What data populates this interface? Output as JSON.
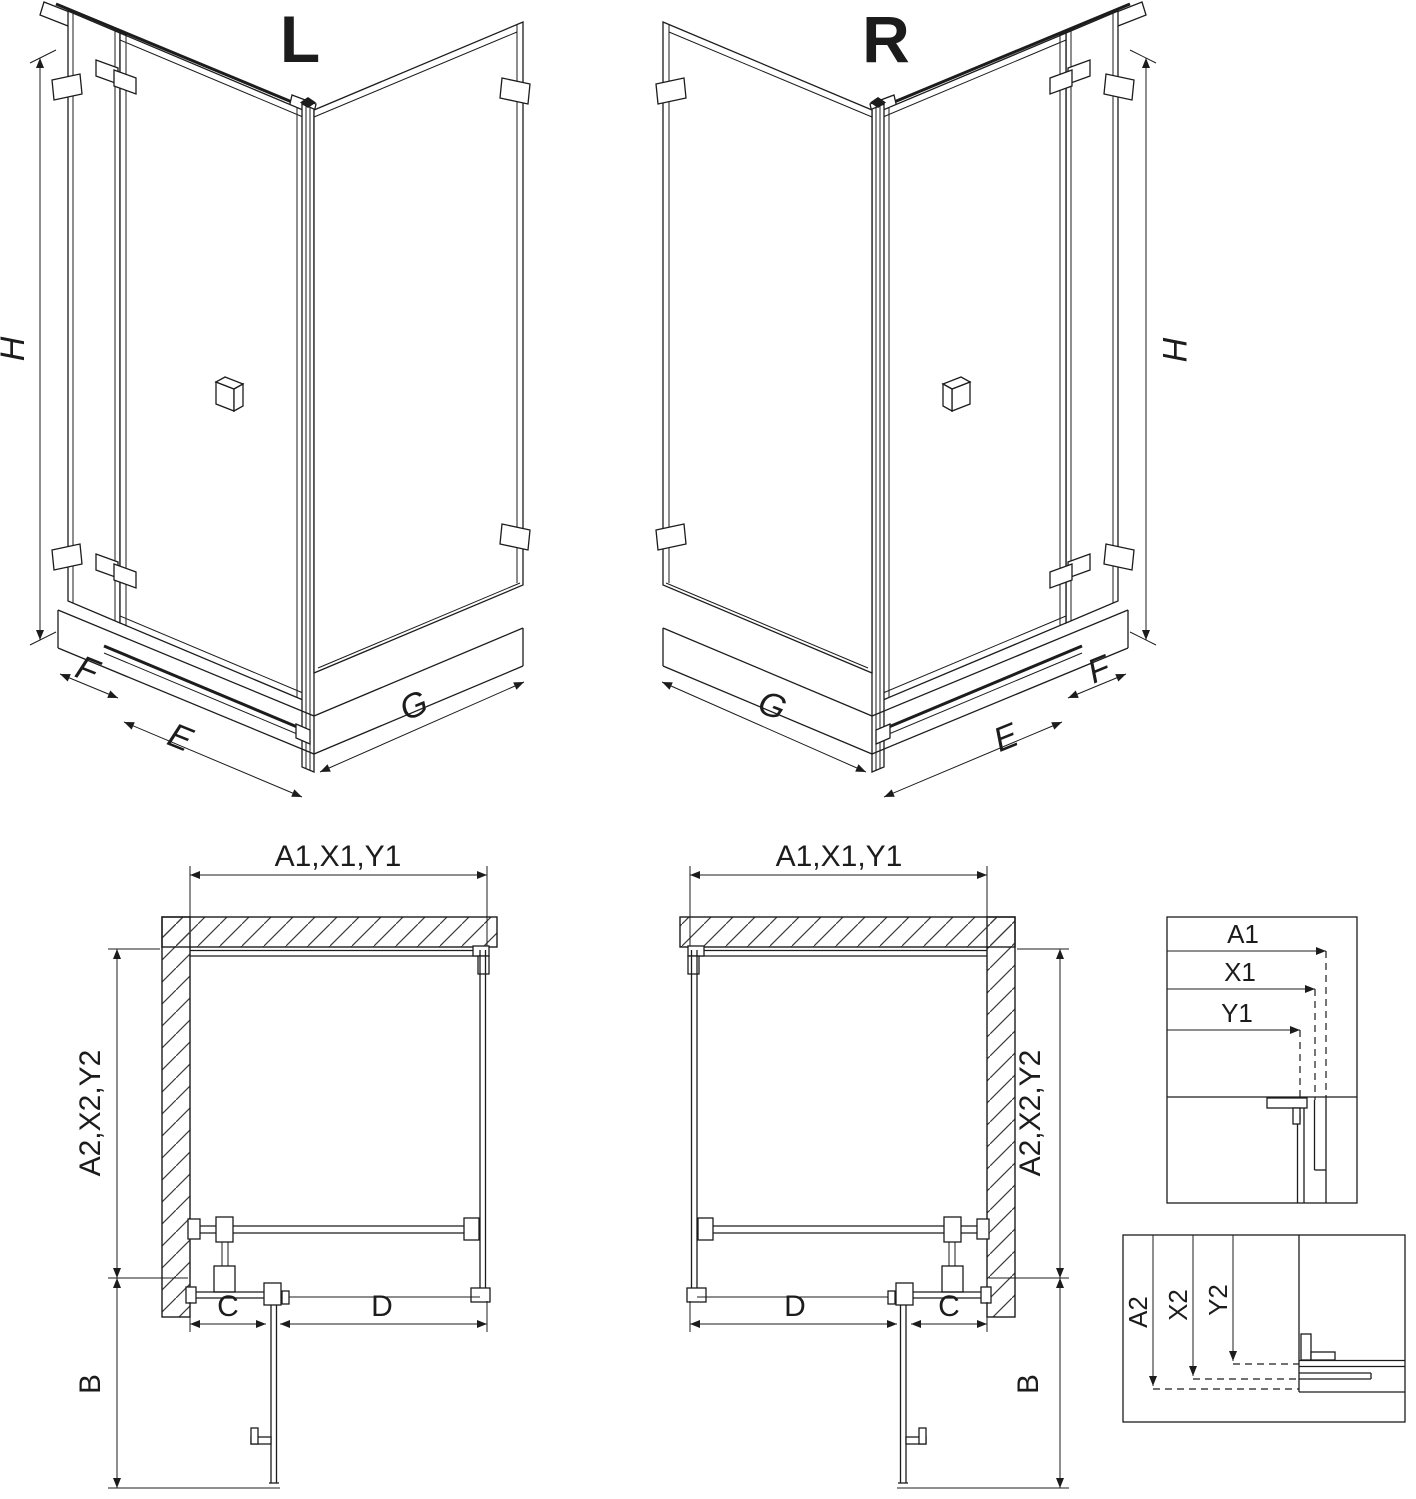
{
  "colors": {
    "line": "#1c1c1c",
    "hatch_line": "#3a3a3a",
    "background": "#ffffff"
  },
  "iso_views": {
    "left": {
      "label": "L",
      "height_dim": "H",
      "side_panel_dim": "F",
      "door_dim": "E",
      "return_panel_dim": "G"
    },
    "right": {
      "label": "R",
      "height_dim": "H",
      "side_panel_dim": "F",
      "door_dim": "E",
      "return_panel_dim": "G"
    }
  },
  "plan_views": {
    "left": {
      "width_dim": "A1,X1,Y1",
      "depth_dim": "A2,X2,Y2",
      "fixed_segment_dim": "C",
      "door_segment_dim": "D",
      "door_swing_dim": "B"
    },
    "right": {
      "width_dim": "A1,X1,Y1",
      "depth_dim": "A2,X2,Y2",
      "fixed_segment_dim": "C",
      "door_segment_dim": "D",
      "door_swing_dim": "B"
    }
  },
  "detail_views": {
    "width_profile": {
      "dims": [
        "A1",
        "X1",
        "Y1"
      ]
    },
    "depth_profile": {
      "dims": [
        "A2",
        "X2",
        "Y2"
      ]
    }
  }
}
